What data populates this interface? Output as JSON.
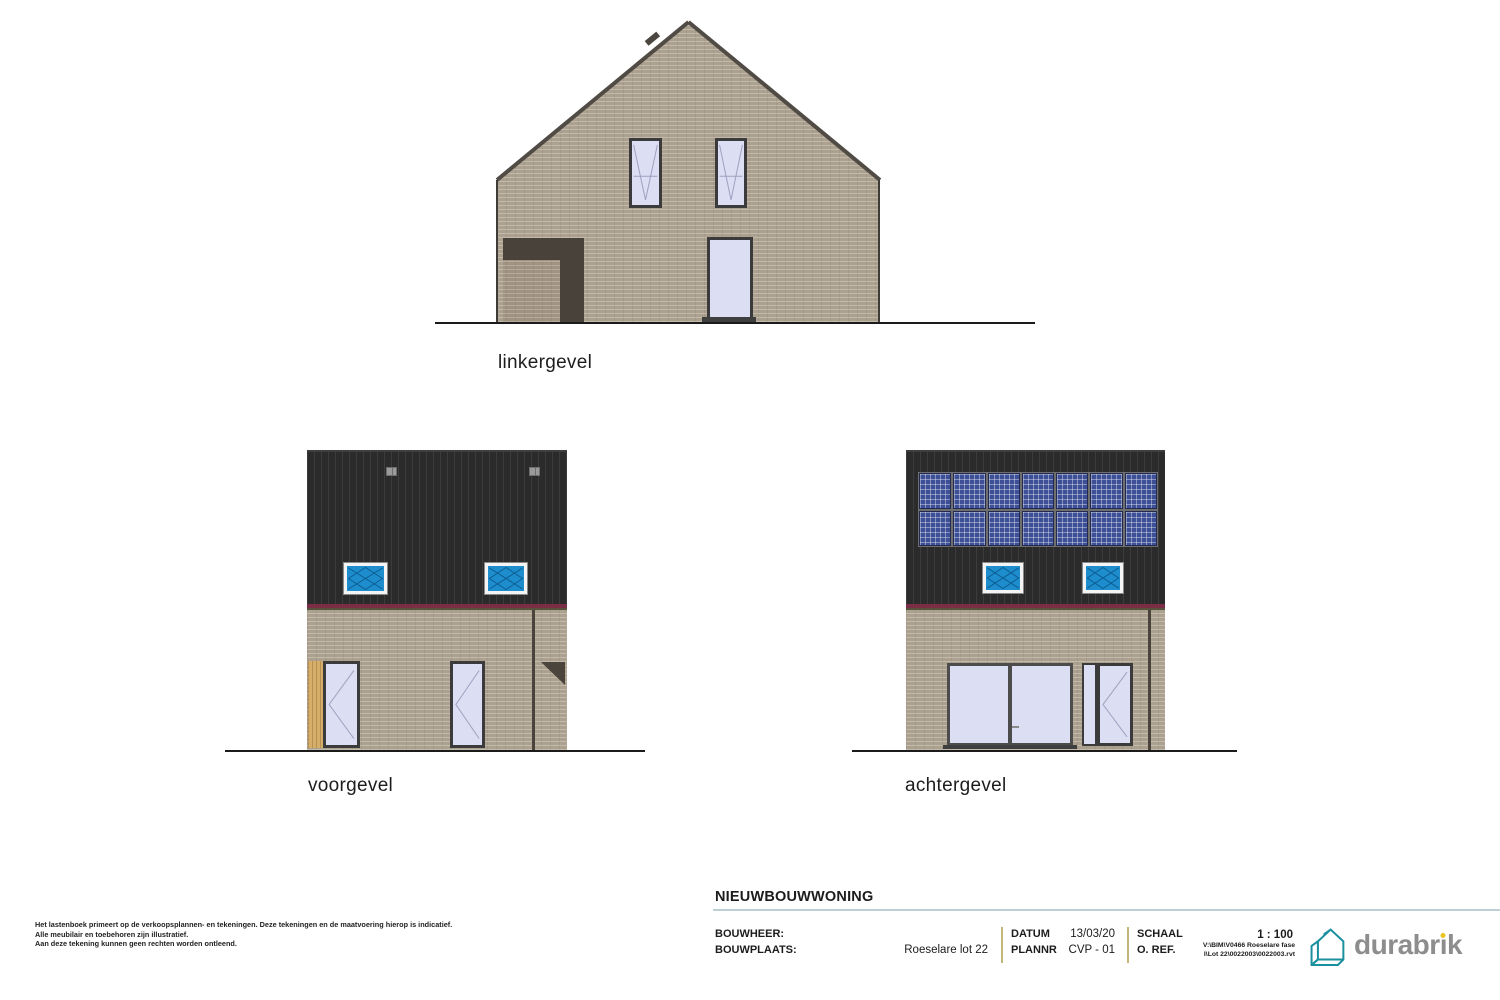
{
  "elevations": {
    "linkergevel": {
      "label": "linkergevel"
    },
    "voorgevel": {
      "label": "voorgevel"
    },
    "achtergevel": {
      "label": "achtergevel"
    }
  },
  "disclaimer": {
    "line1": "Het lastenboek primeert op de verkoopsplannen- en tekeningen. Deze tekeningen en de maatvoering hierop is indicatief.",
    "line2": "Alle meubilair en toebehoren zijn illustratief.",
    "line3": "Aan deze tekening kunnen geen rechten worden ontleend."
  },
  "titleblock": {
    "title": "NIEUWBOUWWONING",
    "bouwheer_label": "BOUWHEER:",
    "bouwplaats_label": "BOUWPLAATS:",
    "location": "Roeselare lot 22",
    "datum_label": "DATUM",
    "datum_value": "13/03/20",
    "plannr_label": "PLANNR",
    "plannr_value": "CVP - 01",
    "schaal_label": "SCHAAL",
    "schaal_value": "1 : 100",
    "oref_label": "O. REF.",
    "file_path_line1": "V:\\BIM\\V0466 Roeselare fase",
    "file_path_line2": "I\\Lot 22\\0022003\\0022003.rvt"
  },
  "logo": {
    "part1": "durabr",
    "dotless_i": "ı",
    "part2": "k",
    "icon": "durabrik-house-icon"
  },
  "colors": {
    "brick": "#aca08f",
    "dark_siding": "#2b2b2b",
    "accent_maroon": "#7a2e45",
    "window_blue": "#1d8dce",
    "solar_blue": "#3d4f97",
    "glass_lavender": "#dcdef4",
    "underline_teal": "#bccfd4",
    "divider_tan": "#c3b57c",
    "wood": "#d6ad69",
    "logo_teal": "#1a8f9e",
    "logo_gray": "#8d8d8d",
    "logo_dot_yellow": "#e7c51e"
  }
}
